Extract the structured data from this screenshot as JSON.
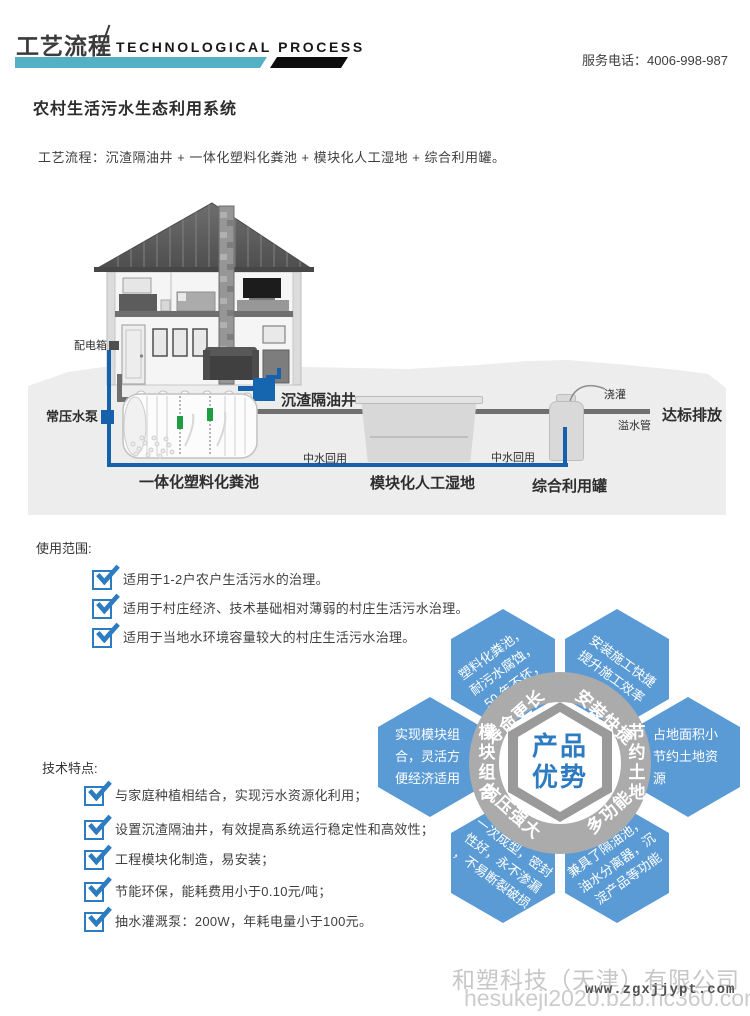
{
  "colors": {
    "accent_teal": "#54b1c5",
    "hex_blue": "#5b9bd5",
    "check_blue": "#2d7bc0",
    "pipe_blue": "#1660ac",
    "center_text_blue": "#2d7bc0"
  },
  "header": {
    "title_cn": "工艺流程",
    "title_en": "TECHNOLOGICAL PROCESS",
    "service_phone": "服务电话：4006-998-987"
  },
  "page": {
    "title": "农村生活污水生态利用系统",
    "process_line": "工艺流程：沉渣隔油井 + 一体化塑料化粪池 + 模块化人工湿地 + 综合利用罐。"
  },
  "diagram": {
    "labels": {
      "distribution_box": "配电箱",
      "pump": "常压水泵",
      "grease_well": "沉渣隔油井",
      "septic_tank": "一体化塑料化粪池",
      "wetland": "模块化人工湿地",
      "utility_tank": "综合利用罐",
      "reuse": "中水回用",
      "irrigation": "浇灌",
      "overflow_pipe": "溢水管",
      "discharge": "达标排放"
    }
  },
  "usage": {
    "heading": "使用范围:",
    "items": [
      "适用于1-2户农户生活污水的治理。",
      "适用于村庄经济、技术基础相对薄弱的村庄生活污水治理。",
      "适用于当地水环境容量较大的村庄生活污水治理。"
    ]
  },
  "advantages": {
    "center_line1": "产品",
    "center_line2": "优势",
    "ring": {
      "top_left": "寿命更长",
      "top_right": "安装快捷",
      "left": "模块组合",
      "right": "节约土地",
      "bottom_left": "抗压强大",
      "bottom_right": "多功能"
    },
    "hexes": {
      "top_left": "塑料化粪池，耐污水腐蚀，50 年不坏，",
      "top_right": "安装施工快捷提升施工效率",
      "left": "实现模块组合，灵活方便经济适用",
      "right": "占地面积小节约土地资源",
      "bottom_left": "一次成型，密封性好，永不渗漏，不易断裂破损",
      "bottom_right": "兼具了隔油池，油水分离器，沉淀产品等功能"
    }
  },
  "features": {
    "heading": "技术特点:",
    "items": [
      "与家庭种植相结合，实现污水资源化利用；",
      "设置沉渣隔油井，有效提高系统运行稳定性和高效性；",
      "工程模块化制造，易安装；",
      "节能环保，能耗费用小于0.10元/吨；",
      "抽水灌溉泵：200W，年耗电量小于100元。"
    ]
  },
  "footer": {
    "company": "和塑科技（天津）有限公司",
    "portal_url": "hesukeji2020.b2b.hc360.com",
    "site_url": "www.zgxjjypt.com"
  }
}
